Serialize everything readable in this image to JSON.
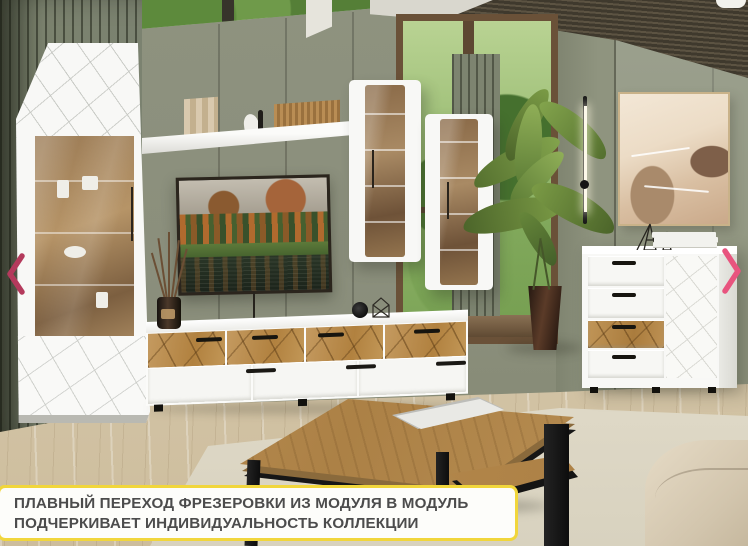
{
  "scene": {
    "description": "furniture-showroom-photo",
    "caption": {
      "line1": "ПЛАВНЫЙ ПЕРЕХОД ФРЕЗЕРОВКИ ИЗ МОДУЛЯ В МОДУЛЬ",
      "line2": "ПОДЧЕРКИВАЕТ ИНДИВИДУАЛЬНОСТЬ КОЛЛЕКЦИИ"
    },
    "carousel": {
      "prev_icon": "chevron-left",
      "next_icon": "chevron-right"
    }
  },
  "colors": {
    "wall_sage": "#8b8f7d",
    "wall_right": "#9aa08e",
    "slat": "#777e6a",
    "oak": "#bd9159",
    "white_furn": "#f8f8f6",
    "floor": "#d6c8ab",
    "rug": "#e3ddcc",
    "caption_bg": "#fdfdfa",
    "caption_border": "#f1d63b",
    "caption_text": "#4c4c4c",
    "arrow_prev": "#b43a5c",
    "arrow_next": "#e8547e",
    "ceiling": "#3f392d",
    "pot": "#54382a",
    "tv_frame": "#2b251d"
  }
}
